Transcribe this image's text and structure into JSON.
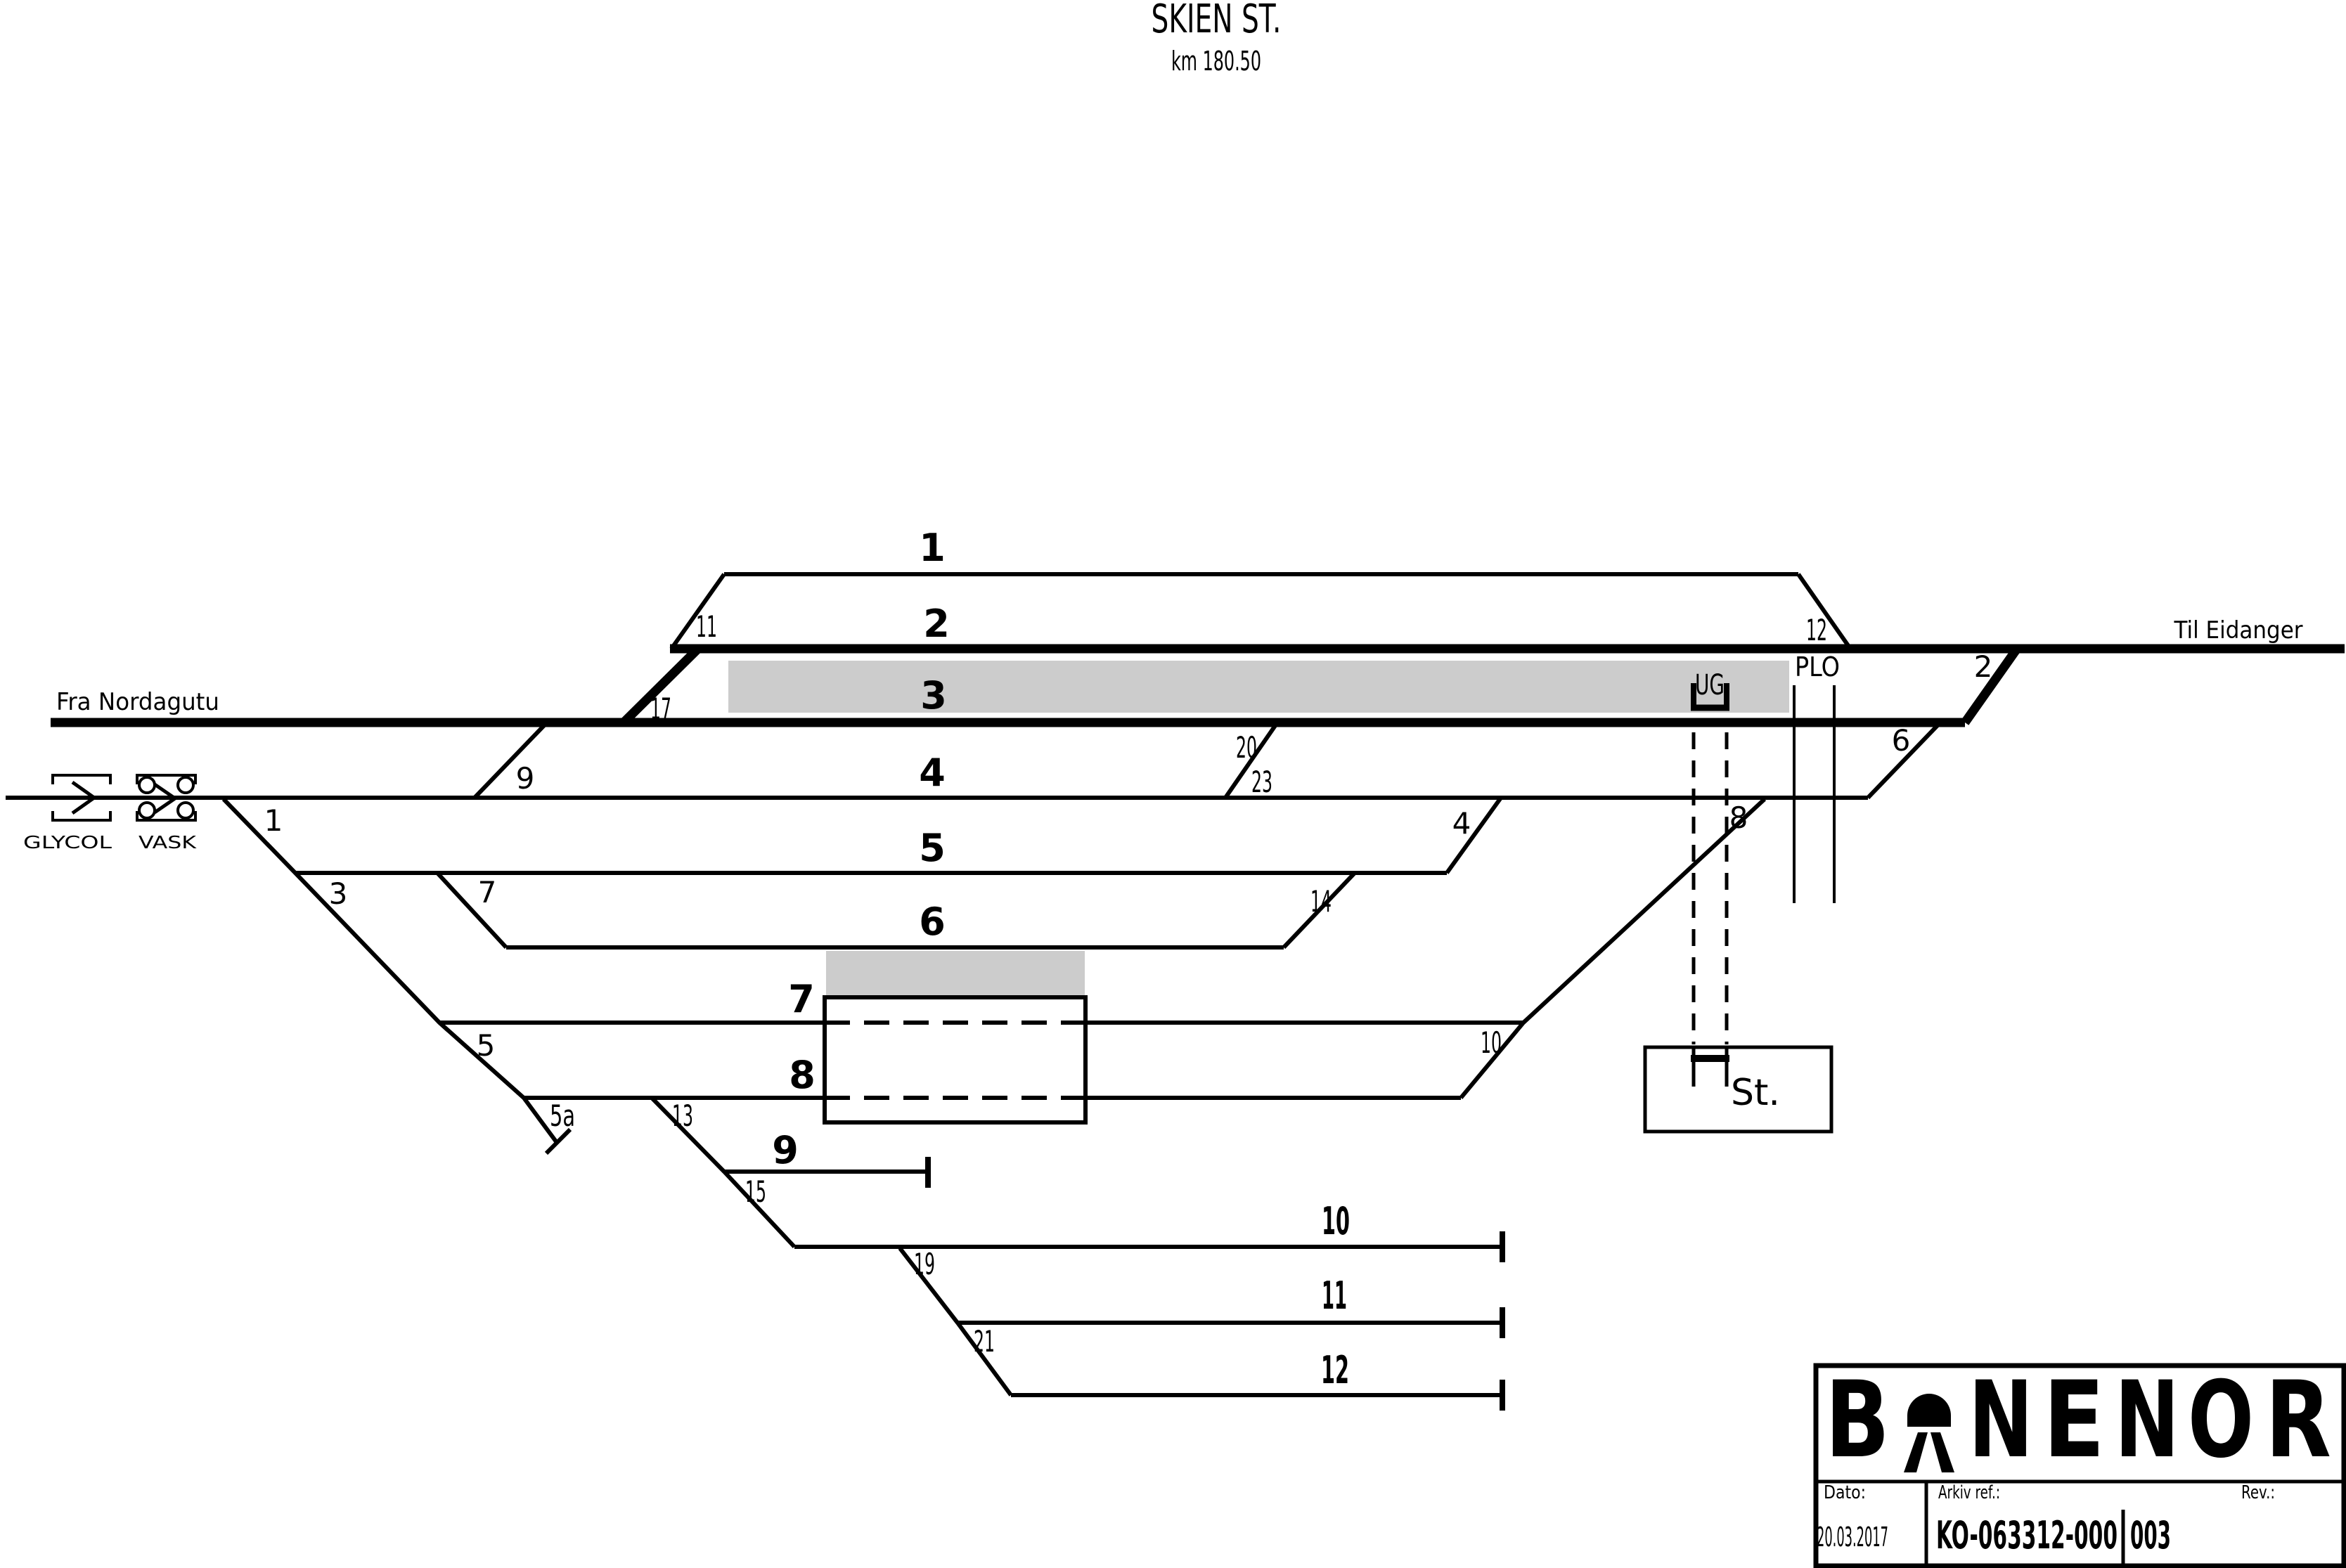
{
  "title": {
    "station": "SKIEN ST.",
    "km": "km 180.50"
  },
  "endpoints": {
    "from": "Fra Nordagutu",
    "to": "Til Eidanger"
  },
  "facilities": {
    "glycol": "GLYCOL",
    "vask": "VASK",
    "underpass": "UG",
    "level_crossing": "PLO",
    "station_building": "St."
  },
  "tracks": {
    "labels": [
      "1",
      "2",
      "3",
      "4",
      "5",
      "6",
      "7",
      "8",
      "9",
      "10",
      "11",
      "12"
    ]
  },
  "switches": {
    "s1": "1",
    "s2": "2",
    "s3": "3",
    "s4": "4",
    "s5": "5",
    "s5a": "5a",
    "s6": "6",
    "s7": "7",
    "s8": "8",
    "s9": "9",
    "s10": "10",
    "s11": "11",
    "s12": "12",
    "s13": "13",
    "s14": "14",
    "s15": "15",
    "s17": "17",
    "s19": "19",
    "s20": "20",
    "s21": "21",
    "s23": "23"
  },
  "title_block": {
    "logo_text": "BANE NOR",
    "logo_letters": [
      "B",
      "N",
      "E",
      "N",
      "O",
      "R"
    ],
    "dato_label": "Dato:",
    "dato_value": "20.03.2017",
    "arkiv_label": "Arkiv ref.:",
    "arkiv_value": "KO-063312-000",
    "rev_label": "Rev.:",
    "rev_value": "003"
  },
  "colors": {
    "line": "#000000",
    "platform": "#cccccc",
    "background": "#ffffff"
  }
}
